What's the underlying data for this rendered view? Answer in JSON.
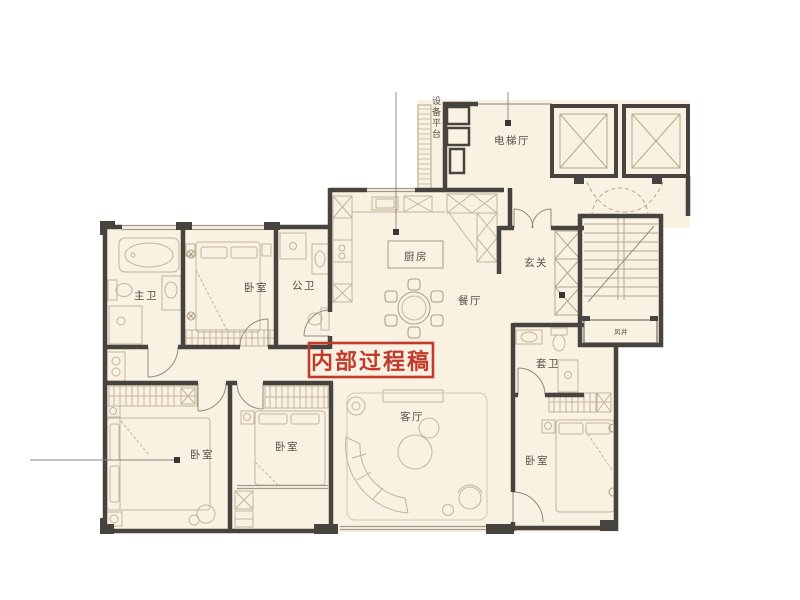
{
  "palette": {
    "floor": "#f9f1e1",
    "wall": "#474440",
    "furniture": "#c3b59c",
    "furniture_dark": "#a99a80",
    "window": "#a09a90",
    "label": "#56504a",
    "stamp_red": "#c13a2c"
  },
  "stamp": {
    "text": "内部过程稿"
  },
  "rooms": {
    "equipment_platform": {
      "label": "设备平台"
    },
    "elevator_hall": {
      "label": "电梯厅"
    },
    "master_bath": {
      "label": "主卫"
    },
    "bedroom_top": {
      "label": "卧室"
    },
    "public_bath": {
      "label": "公卫"
    },
    "kitchen": {
      "label": "厨房"
    },
    "dining": {
      "label": "餐厅"
    },
    "entry": {
      "label": "玄关"
    },
    "air_shaft": {
      "label": "风井"
    },
    "suite_bath": {
      "label": "套卫"
    },
    "living": {
      "label": "客厅"
    },
    "bedroom_left": {
      "label": "卧室"
    },
    "bedroom_mid": {
      "label": "卧室"
    },
    "bedroom_right": {
      "label": "卧室"
    }
  }
}
